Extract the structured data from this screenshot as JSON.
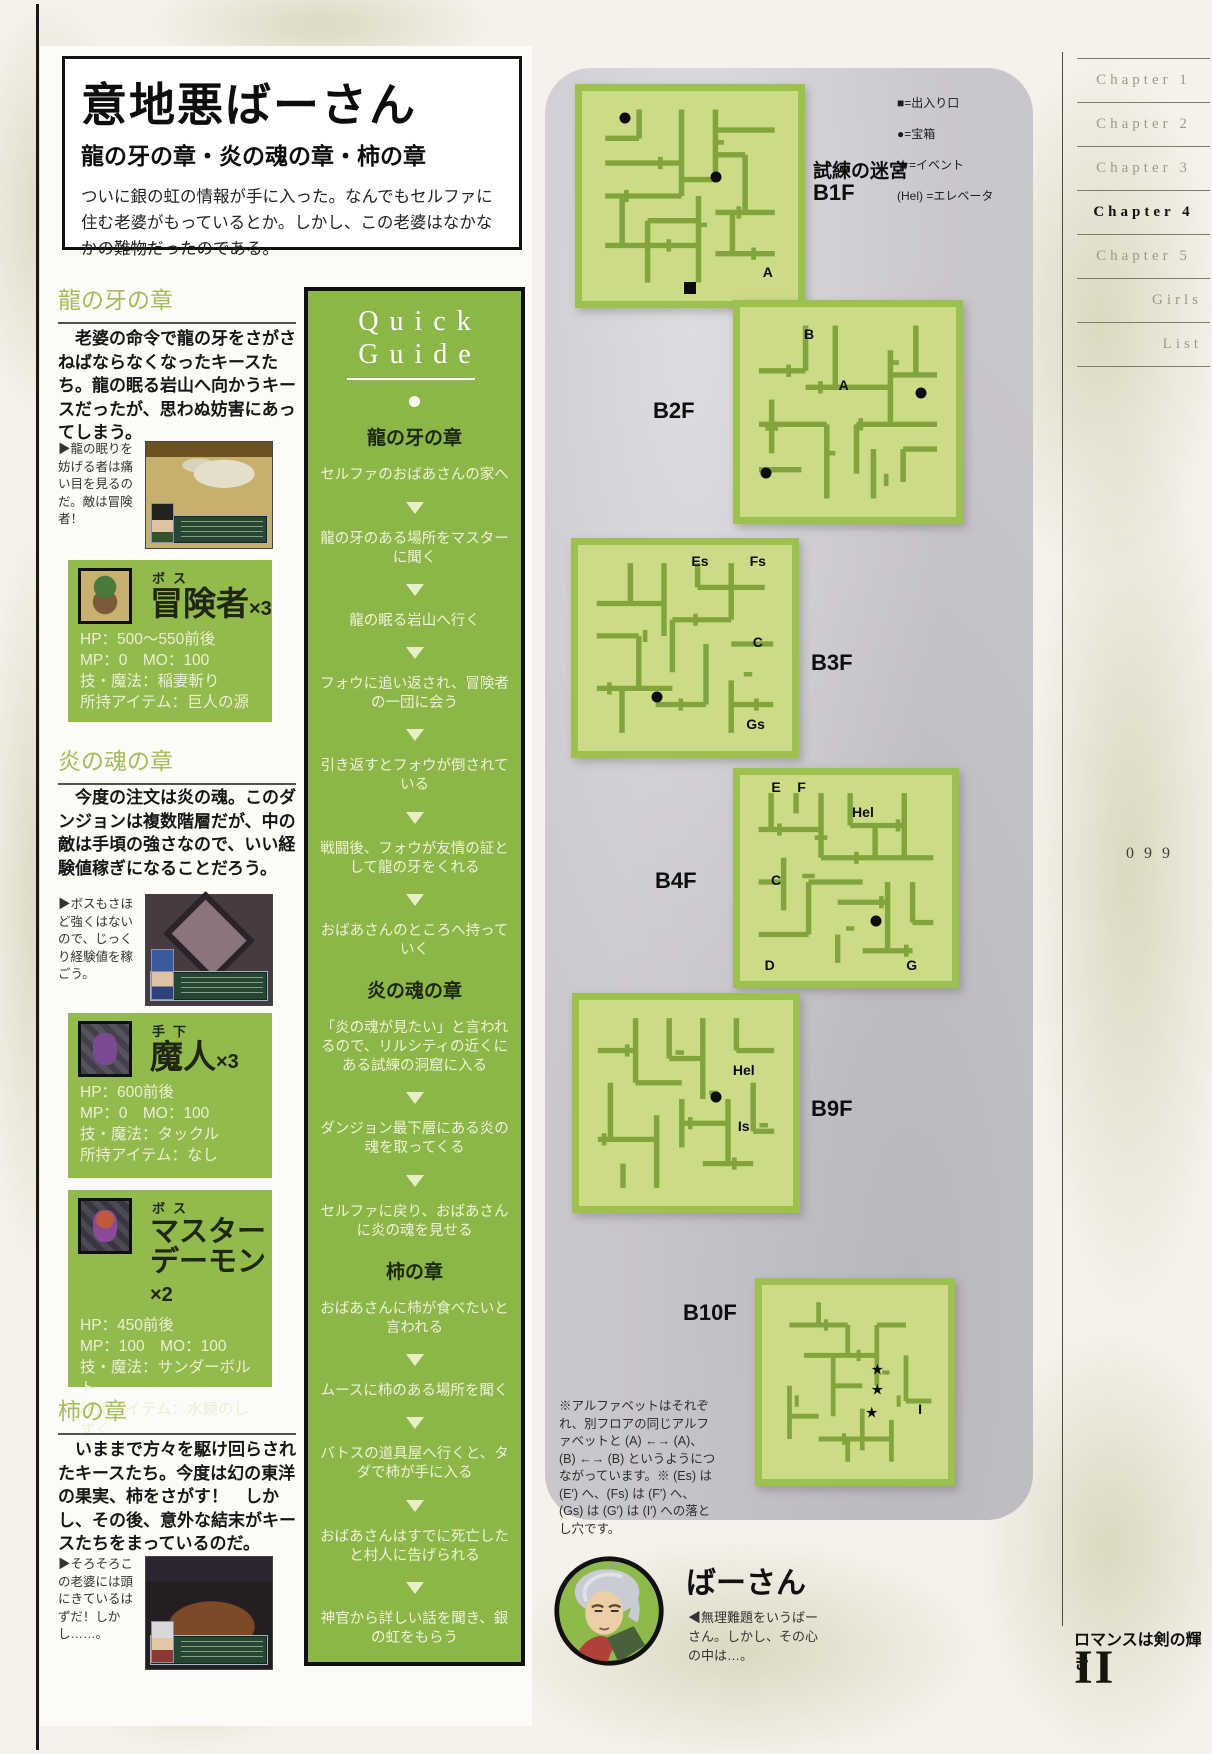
{
  "page": {
    "title": "意地悪ばーさん",
    "subtitle": "龍の牙の章・炎の魂の章・柿の章",
    "intro": "ついに銀の虹の情報が手に入った。なんでもセルファに住む老婆がもっているとか。しかし、この老婆はなかなかの難物だったのである。",
    "page_number": "099",
    "footer_title": "ロマンスは剣の輝き",
    "footer_numeral": "II"
  },
  "sections": [
    {
      "heading": "龍の牙の章",
      "body": "老婆の命令で龍の牙をさがさねばならなくなったキースたち。龍の眠る岩山へ向かうキースだったが、思わぬ妨害にあってしまう。",
      "caption": "▶龍の眠りを妨げる者は痛い目を見るのだ。敵は冒険者！"
    },
    {
      "heading": "炎の魂の章",
      "body": "今度の注文は炎の魂。このダンジョンは複数階層だが、中の敵は手頃の強さなので、いい経験値稼ぎになることだろう。",
      "caption": "▶ボスもさほど強くはないので、じっくり経験値を稼ごう。"
    },
    {
      "heading": "柿の章",
      "body": "いままで方々を駆け回らされたキースたち。今度は幻の東洋の果実、柿をさがす！　しかし、その後、意外な結末がキースたちをまっているのだ。",
      "caption": "▶そろそろこの老婆には頭にきているはずだ！しかし……。"
    }
  ],
  "enemies": [
    {
      "role": "ボス",
      "name": "冒険者",
      "count": "×3",
      "stats": [
        "HP：500〜550前後",
        "MP：0　MO：100",
        "技・魔法：稲妻斬り",
        "所持アイテム：巨人の源"
      ]
    },
    {
      "role": "手下",
      "name": "魔人",
      "count": "×3",
      "stats": [
        "HP：600前後",
        "MP：0　MO：100",
        "技・魔法：タックル",
        "所持アイテム：なし"
      ]
    },
    {
      "role": "ボス",
      "name": "マスターデーモン",
      "count": "×2",
      "stats": [
        "HP：450前後",
        "MP：100　MO：100",
        "技・魔法：サンダーボルト",
        "所持アイテム：水鏡のしずく"
      ]
    }
  ],
  "quick_guide": {
    "title_line1": "Quick",
    "title_line2": "Guide",
    "items": [
      {
        "type": "chapter",
        "text": "龍の牙の章"
      },
      {
        "type": "step",
        "text": "セルファのおばあさんの家へ"
      },
      {
        "type": "step",
        "text": "龍の牙のある場所をマスターに聞く"
      },
      {
        "type": "step",
        "text": "龍の眠る岩山へ行く"
      },
      {
        "type": "step",
        "text": "フォウに追い返され、冒険者の一団に会う"
      },
      {
        "type": "step",
        "text": "引き返すとフォウが倒されている"
      },
      {
        "type": "step",
        "text": "戦闘後、フォウが友情の証として龍の牙をくれる"
      },
      {
        "type": "step",
        "text": "おばあさんのところへ持っていく"
      },
      {
        "type": "chapter",
        "text": "炎の魂の章"
      },
      {
        "type": "step",
        "text": "「炎の魂が見たい」と言われるので、リルシティの近くにある試練の洞窟に入る"
      },
      {
        "type": "step",
        "text": "ダンジョン最下層にある炎の魂を取ってくる"
      },
      {
        "type": "step",
        "text": "セルファに戻り、おばあさんに炎の魂を見せる"
      },
      {
        "type": "chapter",
        "text": "柿の章"
      },
      {
        "type": "step",
        "text": "おばあさんに柿が食べたいと言われる"
      },
      {
        "type": "step",
        "text": "ムースに柿のある場所を聞く"
      },
      {
        "type": "step",
        "text": "バトスの道具屋へ行くと、タダで柿が手に入る"
      },
      {
        "type": "step",
        "text": "おばあさんはすでに死亡したと村人に告げられる"
      },
      {
        "type": "step",
        "text": "神官から詳しい話を聞き、銀の虹をもらう"
      }
    ]
  },
  "legend": {
    "items": [
      "■=出入り口",
      "●=宝箱",
      "★=イベント",
      "(Hel) =エレベータ"
    ]
  },
  "symbols": {
    "event_star": "★"
  },
  "maps": {
    "dungeon_name": "試練の迷宮",
    "floors": [
      {
        "label": "B1F",
        "markers": [
          {
            "type": "treasure"
          },
          {
            "type": "treasure"
          },
          {
            "type": "entrance"
          },
          {
            "type": "letter",
            "text": "A"
          }
        ]
      },
      {
        "label": "B2F",
        "markers": [
          {
            "type": "letter",
            "text": "B"
          },
          {
            "type": "letter",
            "text": "A"
          },
          {
            "type": "treasure"
          },
          {
            "type": "treasure"
          }
        ]
      },
      {
        "label": "B3F",
        "markers": [
          {
            "type": "letter",
            "text": "Es"
          },
          {
            "type": "letter",
            "text": "Fs"
          },
          {
            "type": "letter",
            "text": "C"
          },
          {
            "type": "treasure"
          },
          {
            "type": "letter",
            "text": "Gs"
          }
        ]
      },
      {
        "label": "B4F",
        "markers": [
          {
            "type": "letter",
            "text": "E"
          },
          {
            "type": "letter",
            "text": "F"
          },
          {
            "type": "letter",
            "text": "Hel"
          },
          {
            "type": "letter",
            "text": "C"
          },
          {
            "type": "treasure"
          },
          {
            "type": "letter",
            "text": "D"
          },
          {
            "type": "letter",
            "text": "G"
          }
        ]
      },
      {
        "label": "B9F",
        "markers": [
          {
            "type": "letter",
            "text": "Hel"
          },
          {
            "type": "treasure"
          },
          {
            "type": "letter",
            "text": "Is"
          }
        ]
      },
      {
        "label": "B10F",
        "markers": [
          {
            "type": "event"
          },
          {
            "type": "event"
          },
          {
            "type": "event"
          },
          {
            "type": "letter",
            "text": "I"
          }
        ]
      }
    ],
    "note": "※アルファベットはそれぞれ、別フロアの同じアルファベットと (A) ←→ (A)、(B) ←→ (B) というようにつながっています。※ (Es) は (E′) へ、(Fs) は (F′) へ、(Gs) は (G′) は (I′) への落とし穴です。"
  },
  "character": {
    "name": "ばーさん",
    "caption": "◀無理難題をいうばーさん。しかし、その心の中は…。"
  },
  "chapters": {
    "tabs": [
      "Chapter 1",
      "Chapter 2",
      "Chapter 3",
      "Chapter 4",
      "Chapter 5",
      "Girls",
      "List"
    ],
    "active": "Chapter 4"
  }
}
